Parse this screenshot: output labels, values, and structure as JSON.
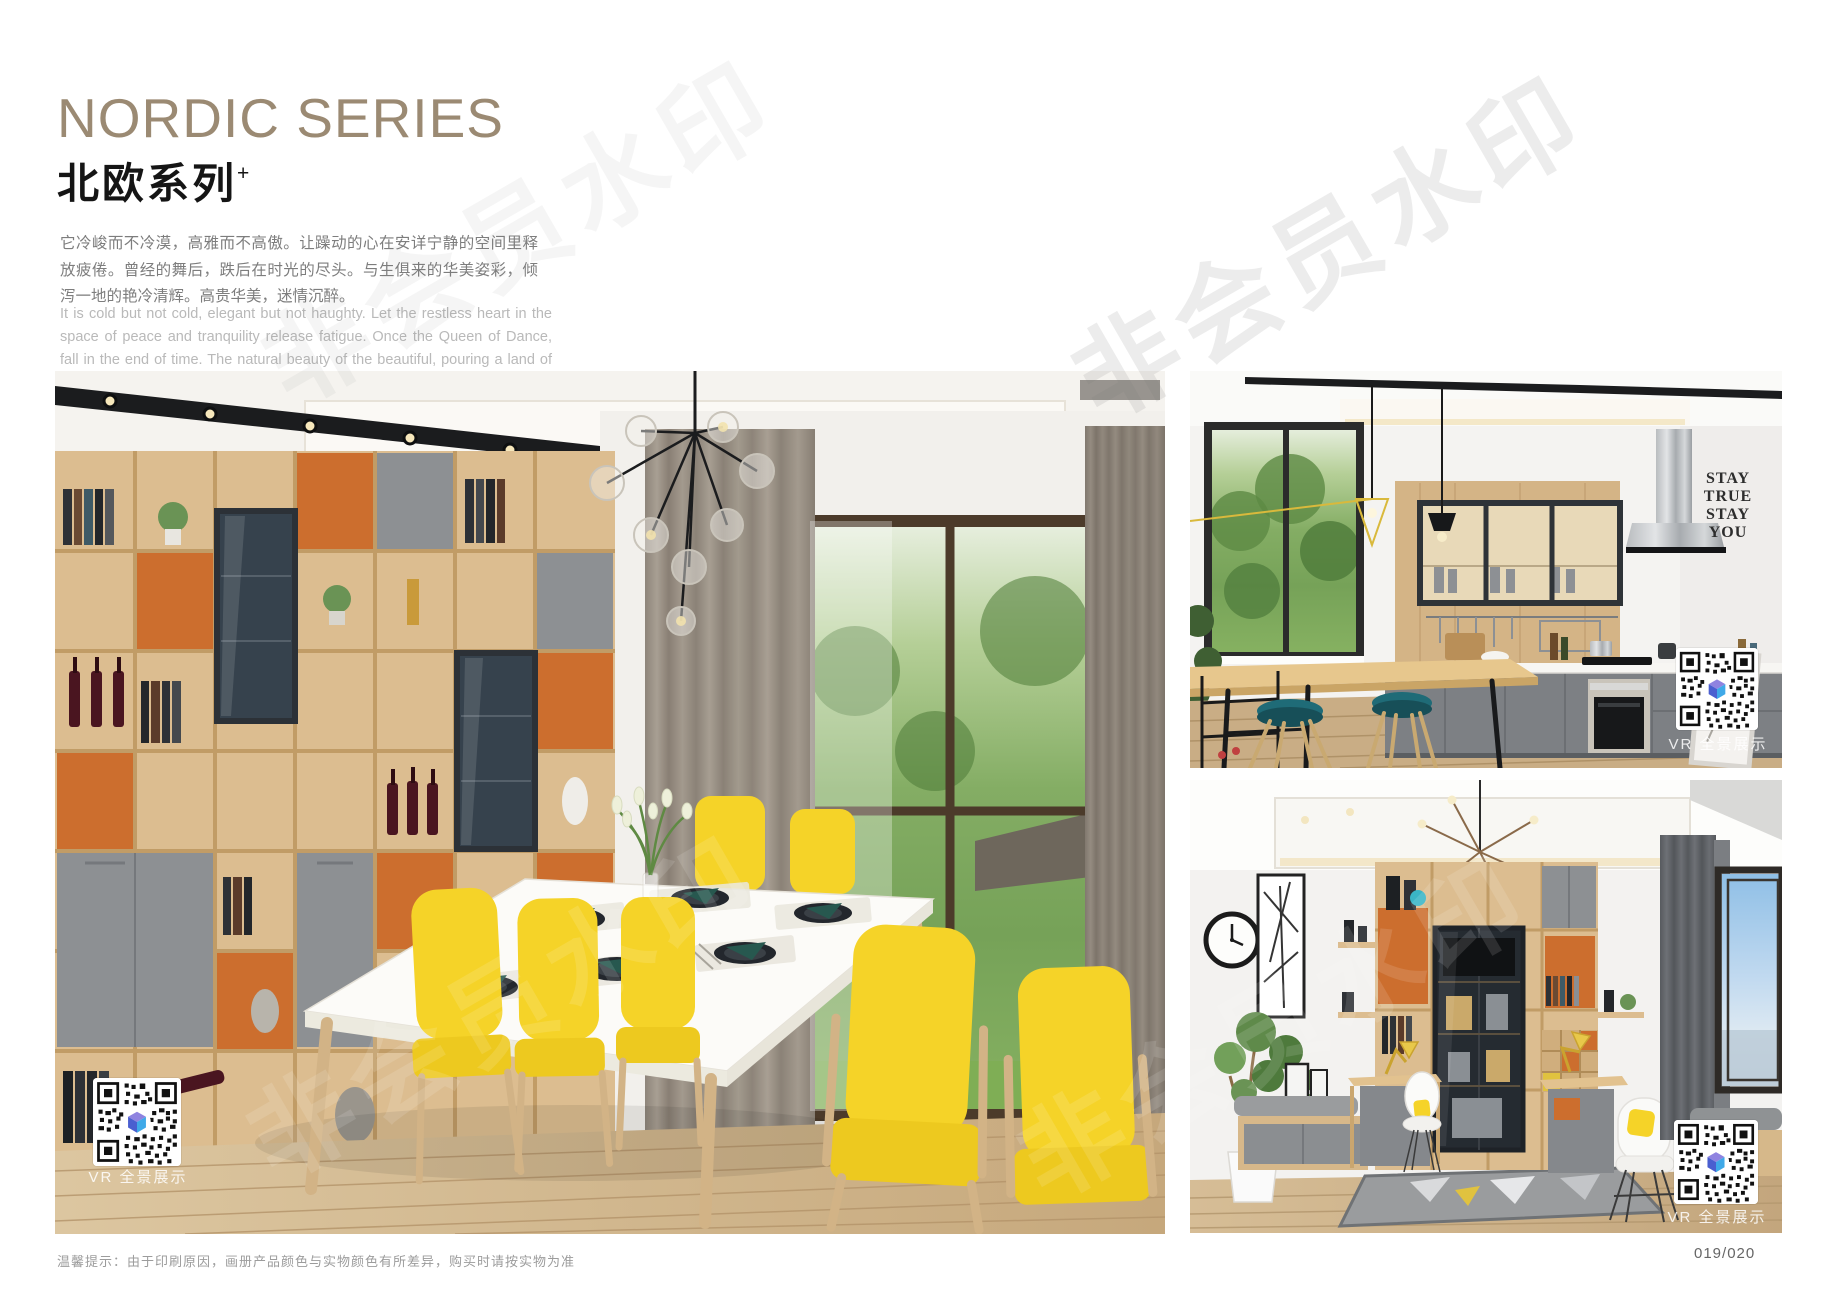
{
  "page": {
    "title_en": "NORDIC SERIES",
    "title_cn": "北欧系列",
    "title_sup": "+",
    "desc_cn": "它冷峻而不冷漠，高雅而不高傲。让躁动的心在安详宁静的空间里释放疲倦。曾经的舞后，跌后在时光的尽头。与生俱来的华美姿彩，倾泻一地的艳冷清辉。高贵华美，迷情沉醉。",
    "desc_en": "It is cold but not cold, elegant but not haughty. Let the restless heart in the space of peace and tranquility release fatigue. Once the Queen of Dance, fall in the end of time. The natural beauty of the beautiful, pouring a land of cold and pure brilliance. Noble, beautiful, enchanted.",
    "footer_note": "温馨提示：由于印刷原因，画册产品颜色与实物颜色有所差异，购买时请按实物为准",
    "page_number": "019/020",
    "watermark": "非会员水印"
  },
  "photos": {
    "dining": {
      "vr_label": "VR 全景展示"
    },
    "kitchen": {
      "vr_label": "VR 全景展示",
      "wall_lines": [
        "STAY",
        "TRUE",
        "STAY",
        "YOU"
      ]
    },
    "study": {
      "vr_label": "VR 全景展示"
    }
  },
  "colors": {
    "bronze": "#9b8a73",
    "orange": "#cc6e2e",
    "yellow": "#f5d328",
    "teal": "#27584f",
    "wood": "#dcbd90",
    "wood_dark": "#c19c66",
    "gray_door": "#8d9093",
    "ink": "#1b1c1e"
  }
}
